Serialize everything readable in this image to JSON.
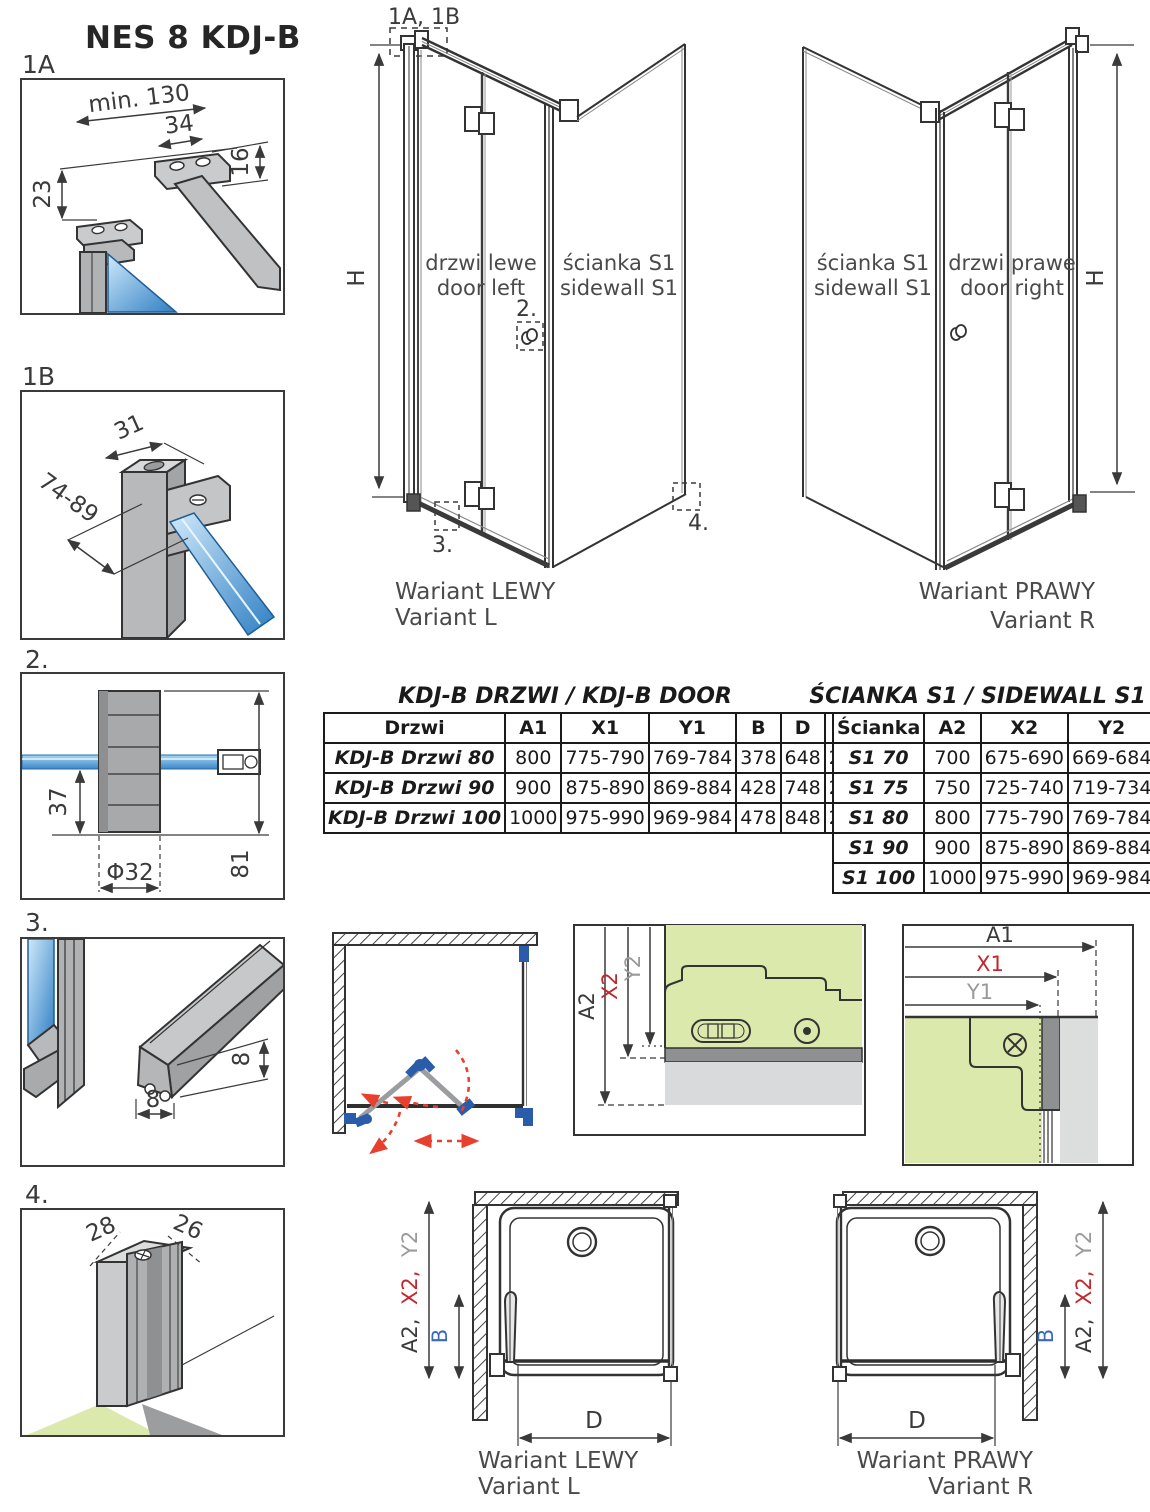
{
  "title": "NES 8 KDJ-B",
  "details": {
    "d1a": {
      "label": "1A",
      "dim_min": "min. 130",
      "dim_34": "34",
      "dim_16": "16",
      "dim_23": "23"
    },
    "d1b": {
      "label": "1B",
      "dim_31": "31",
      "dim_range": "74-89"
    },
    "d2": {
      "label": "2.",
      "dim_37": "37",
      "dim_phi": "Φ32",
      "dim_81": "81"
    },
    "d3": {
      "label": "3.",
      "dim_8v": "8",
      "dim_8h": "8"
    },
    "d4": {
      "label": "4.",
      "dim_28": "28",
      "dim_26": "26"
    }
  },
  "iso_left": {
    "marker_top": "1A, 1B",
    "h": "H",
    "door_pl": "drzwi lewe",
    "door_en": "door left",
    "wall_pl": "ścianka S1",
    "wall_en": "sidewall S1",
    "m2": "2.",
    "m3": "3.",
    "m4": "4.",
    "caption_pl": "Wariant LEWY",
    "caption_en": "Variant L"
  },
  "iso_right": {
    "h": "H",
    "wall_pl": "ścianka S1",
    "wall_en": "sidewall S1",
    "door_pl": "drzwi prawe",
    "door_en": "door right",
    "caption_pl": "Wariant PRAWY",
    "caption_en": "Variant R"
  },
  "door_table": {
    "title": "KDJ-B  DRZWI / KDJ-B DOOR",
    "headers": [
      "Drzwi",
      "A1",
      "X1",
      "Y1",
      "B",
      "D",
      "H"
    ],
    "rows": [
      [
        "KDJ-B Drzwi 80",
        "800",
        "775-790",
        "769-784",
        "378",
        "648",
        "2000"
      ],
      [
        "KDJ-B Drzwi 90",
        "900",
        "875-890",
        "869-884",
        "428",
        "748",
        "2000"
      ],
      [
        "KDJ-B Drzwi 100",
        "1000",
        "975-990",
        "969-984",
        "478",
        "848",
        "2000"
      ]
    ]
  },
  "sidewall_table": {
    "title": "ŚCIANKA S1 / SIDEWALL S1",
    "headers": [
      "Ścianka",
      "A2",
      "X2",
      "Y2"
    ],
    "rows": [
      [
        "S1 70",
        "700",
        "675-690",
        "669-684"
      ],
      [
        "S1 75",
        "750",
        "725-740",
        "719-734"
      ],
      [
        "S1 80",
        "800",
        "775-790",
        "769-784"
      ],
      [
        "S1 90",
        "900",
        "875-890",
        "869-884"
      ],
      [
        "S1 100",
        "1000",
        "975-990",
        "969-984"
      ]
    ]
  },
  "detail_mid": {
    "a2": "A2",
    "x2": "X2",
    "y2": "Y2"
  },
  "detail_right": {
    "a1": "A1",
    "x1": "X1",
    "y1": "Y1"
  },
  "plan_left": {
    "a2": "A2,",
    "x2": "X2,",
    "y2": "Y2",
    "b": "B",
    "d": "D",
    "caption_pl": "Wariant LEWY",
    "caption_en": "Variant L"
  },
  "plan_right": {
    "a2": "A2,",
    "x2": "X2,",
    "y2": "Y2",
    "b": "B",
    "d": "D",
    "caption_pl": "Wariant PRAWY",
    "caption_en": "Variant R"
  },
  "colors": {
    "dim_red": "#c1272d",
    "dim_gray": "#9a9a9c",
    "dim_blue": "#3a6abd",
    "dim_purple": "#5b4fa0",
    "glass_blue": "#3b86c8",
    "floor_green": "#dce9ac",
    "arrow_red": "#e8402f"
  }
}
